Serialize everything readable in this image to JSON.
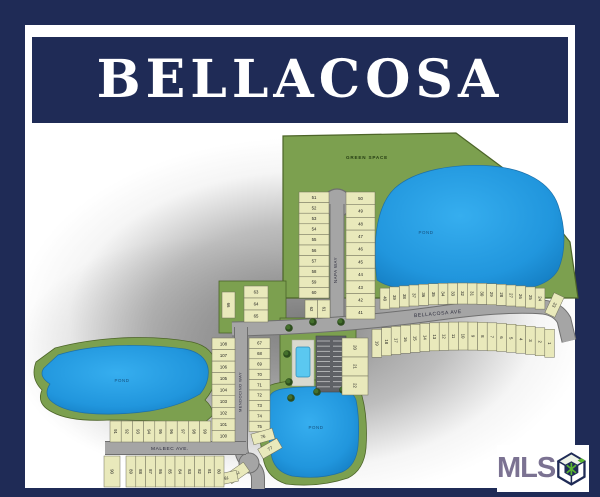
{
  "title": "BELLACOSA",
  "watermark": {
    "text": "MLS",
    "icon": "cube-logo"
  },
  "map": {
    "labels": {
      "green_space": "GREEN SPACE",
      "pond": "POND",
      "napa_way": "NAPA WAY",
      "bellacosa_ave": "BELLACOSA AVE",
      "mendocino_way": "MENDOCINO WAY",
      "malbec_ave": "MALBEC AVE."
    },
    "ponds": [
      "POND",
      "POND",
      "POND"
    ],
    "lot_groups": {
      "napa_left": [
        51,
        52,
        53,
        54,
        55,
        56,
        57,
        58,
        59,
        60
      ],
      "napa_right": [
        50,
        49,
        48,
        47,
        46,
        45,
        44,
        43,
        42,
        41
      ],
      "upper_west_col": [
        63,
        64,
        65
      ],
      "lot_66": [
        66
      ],
      "lots_61_62": [
        62,
        61
      ],
      "bellacosa_north": [
        40,
        39,
        38,
        37,
        36,
        35,
        34,
        33,
        32,
        31,
        30,
        29,
        28,
        27,
        26,
        25,
        24
      ],
      "lot_23": [
        23
      ],
      "bellacosa_south_trio": [
        20,
        21,
        22
      ],
      "bellacosa_south": [
        19,
        18,
        17,
        16,
        15,
        14,
        13,
        12,
        11,
        10,
        9,
        8,
        7,
        6,
        5,
        4,
        3,
        2,
        1
      ],
      "mendocino_west": [
        108,
        107,
        106,
        105,
        104,
        103,
        102,
        101,
        100
      ],
      "mendocino_east": [
        67,
        68,
        69,
        70,
        71,
        72,
        73,
        74,
        75
      ],
      "lots_76_77": [
        76,
        77
      ],
      "lots_78_79": [
        79,
        78
      ],
      "malbec_north": [
        91,
        92,
        93,
        94,
        95,
        96,
        97,
        98,
        99
      ],
      "lot_90": [
        90
      ],
      "malbec_south": [
        89,
        88,
        87,
        86,
        85,
        84,
        83,
        82,
        81,
        80
      ]
    }
  },
  "colors": {
    "border_navy": "#1f2b56",
    "banner_text": "#ffffff",
    "green_space": "#7ca04f",
    "green_edge": "#4c6428",
    "lot_fill": "#e9e9bb",
    "street_gray": "#a5a5a5",
    "pond_blue": "#2196dd",
    "pond_label": "#15507d",
    "mls_purple": "#7b7292"
  }
}
